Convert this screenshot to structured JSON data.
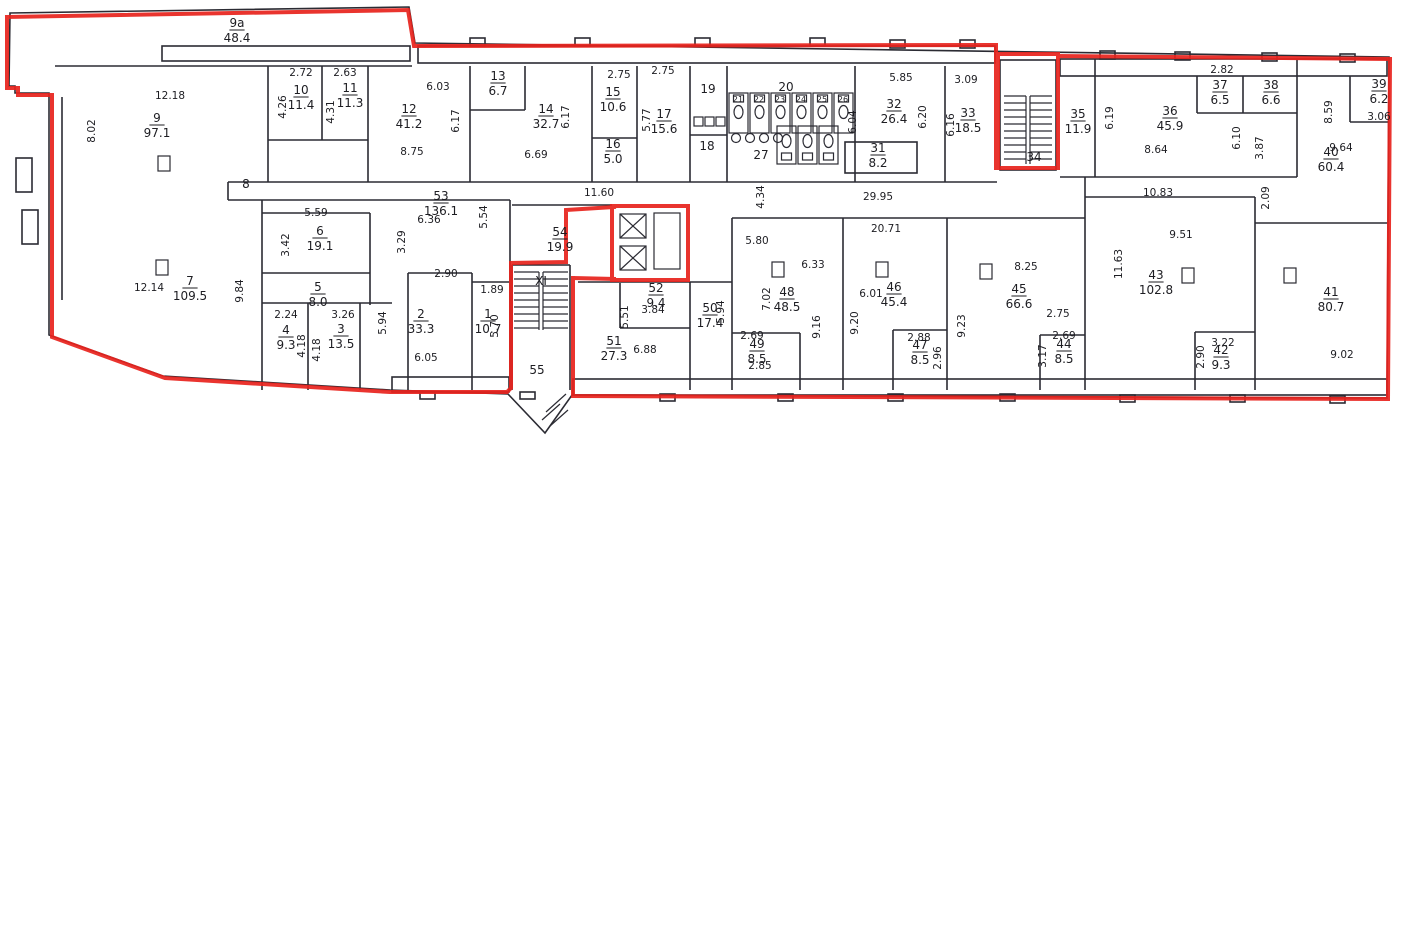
{
  "document": {
    "kind": "scanned floor plan with red lease-boundary outline",
    "background": "#ffffff"
  },
  "colors": {
    "boundary_red": "#e8231d",
    "wall_ink": "#2b2b33",
    "text_ink": "#1d1d22"
  },
  "rooms": [
    {
      "num": "9a",
      "area": "48.4",
      "x": 237,
      "y": 27
    },
    {
      "num": "9",
      "area": "97.1",
      "x": 157,
      "y": 122
    },
    {
      "num": "10",
      "area": "11.4",
      "x": 301,
      "y": 94
    },
    {
      "num": "11",
      "area": "11.3",
      "x": 350,
      "y": 92
    },
    {
      "num": "12",
      "area": "41.2",
      "x": 409,
      "y": 113
    },
    {
      "num": "13",
      "area": "6.7",
      "x": 498,
      "y": 80
    },
    {
      "num": "14",
      "area": "32.7",
      "x": 546,
      "y": 113
    },
    {
      "num": "15",
      "area": "10.6",
      "x": 613,
      "y": 96
    },
    {
      "num": "16",
      "area": "5.0",
      "x": 613,
      "y": 148
    },
    {
      "num": "17",
      "area": "15.6",
      "x": 664,
      "y": 118
    },
    {
      "num": "31",
      "area": "8.2",
      "x": 878,
      "y": 152
    },
    {
      "num": "32",
      "area": "26.4",
      "x": 894,
      "y": 108
    },
    {
      "num": "33",
      "area": "18.5",
      "x": 968,
      "y": 117
    },
    {
      "num": "35",
      "area": "11.9",
      "x": 1078,
      "y": 118
    },
    {
      "num": "36",
      "area": "45.9",
      "x": 1170,
      "y": 115
    },
    {
      "num": "37",
      "area": "6.5",
      "x": 1220,
      "y": 89
    },
    {
      "num": "38",
      "area": "6.6",
      "x": 1271,
      "y": 89
    },
    {
      "num": "39",
      "area": "6.2",
      "x": 1379,
      "y": 88
    },
    {
      "num": "40",
      "area": "60.4",
      "x": 1331,
      "y": 156
    },
    {
      "num": "7",
      "area": "109.5",
      "x": 190,
      "y": 285
    },
    {
      "num": "6",
      "area": "19.1",
      "x": 320,
      "y": 235
    },
    {
      "num": "5",
      "area": "8.0",
      "x": 318,
      "y": 291
    },
    {
      "num": "4",
      "area": "9.3",
      "x": 286,
      "y": 334
    },
    {
      "num": "3",
      "area": "13.5",
      "x": 341,
      "y": 333
    },
    {
      "num": "2",
      "area": "33.3",
      "x": 421,
      "y": 318
    },
    {
      "num": "1",
      "area": "10.7",
      "x": 488,
      "y": 318
    },
    {
      "num": "53",
      "area": "136.1",
      "x": 441,
      "y": 200
    },
    {
      "num": "54",
      "area": "19.9",
      "x": 560,
      "y": 236
    },
    {
      "num": "52",
      "area": "9.4",
      "x": 656,
      "y": 292
    },
    {
      "num": "51",
      "area": "27.3",
      "x": 614,
      "y": 345
    },
    {
      "num": "50",
      "area": "17.4",
      "x": 710,
      "y": 312
    },
    {
      "num": "48",
      "area": "48.5",
      "x": 787,
      "y": 296
    },
    {
      "num": "49",
      "area": "8.5",
      "x": 757,
      "y": 348
    },
    {
      "num": "46",
      "area": "45.4",
      "x": 894,
      "y": 291
    },
    {
      "num": "47",
      "area": "8.5",
      "x": 920,
      "y": 349
    },
    {
      "num": "45",
      "area": "66.6",
      "x": 1019,
      "y": 293
    },
    {
      "num": "44",
      "area": "8.5",
      "x": 1064,
      "y": 348
    },
    {
      "num": "43",
      "area": "102.8",
      "x": 1156,
      "y": 279
    },
    {
      "num": "42",
      "area": "9.3",
      "x": 1221,
      "y": 354
    },
    {
      "num": "41",
      "area": "80.7",
      "x": 1331,
      "y": 296
    }
  ],
  "labels": [
    {
      "text": "8",
      "x": 246,
      "y": 188,
      "small": false
    },
    {
      "text": "19",
      "x": 708,
      "y": 93,
      "small": false
    },
    {
      "text": "18",
      "x": 707,
      "y": 150,
      "small": false
    },
    {
      "text": "20",
      "x": 786,
      "y": 91,
      "small": false
    },
    {
      "text": "27",
      "x": 761,
      "y": 159,
      "small": false
    },
    {
      "text": "34",
      "x": 1034,
      "y": 161,
      "small": false
    },
    {
      "text": "55",
      "x": 537,
      "y": 374,
      "small": false
    },
    {
      "text": "XI",
      "x": 541,
      "y": 285,
      "small": false
    },
    {
      "text": "21",
      "x": 738,
      "y": 102,
      "small": true
    },
    {
      "text": "22",
      "x": 759,
      "y": 102,
      "small": true
    },
    {
      "text": "23",
      "x": 780,
      "y": 102,
      "small": true
    },
    {
      "text": "24",
      "x": 801,
      "y": 102,
      "small": true
    },
    {
      "text": "25",
      "x": 822,
      "y": 102,
      "small": true
    },
    {
      "text": "26",
      "x": 843,
      "y": 102,
      "small": true
    }
  ],
  "dimensions": [
    {
      "text": "12.18",
      "x": 170,
      "y": 99,
      "rot": 0
    },
    {
      "text": "8.02",
      "x": 95,
      "y": 131,
      "rot": 90
    },
    {
      "text": "2.72",
      "x": 301,
      "y": 76,
      "rot": 0
    },
    {
      "text": "4.26",
      "x": 286,
      "y": 107,
      "rot": 90
    },
    {
      "text": "2.63",
      "x": 345,
      "y": 76,
      "rot": 0
    },
    {
      "text": "4.31",
      "x": 334,
      "y": 112,
      "rot": 90
    },
    {
      "text": "6.03",
      "x": 438,
      "y": 90,
      "rot": 0
    },
    {
      "text": "6.17",
      "x": 459,
      "y": 121,
      "rot": 90
    },
    {
      "text": "8.75",
      "x": 412,
      "y": 155,
      "rot": 0
    },
    {
      "text": "6.17",
      "x": 569,
      "y": 117,
      "rot": 90
    },
    {
      "text": "6.69",
      "x": 536,
      "y": 158,
      "rot": 0
    },
    {
      "text": "2.75",
      "x": 619,
      "y": 78,
      "rot": 0
    },
    {
      "text": "2.75",
      "x": 663,
      "y": 74,
      "rot": 0
    },
    {
      "text": "5.77",
      "x": 650,
      "y": 120,
      "rot": 90
    },
    {
      "text": "5.85",
      "x": 901,
      "y": 81,
      "rot": 0
    },
    {
      "text": "6.04",
      "x": 856,
      "y": 122,
      "rot": 90
    },
    {
      "text": "6.20",
      "x": 926,
      "y": 117,
      "rot": 90
    },
    {
      "text": "6.16",
      "x": 954,
      "y": 125,
      "rot": 90
    },
    {
      "text": "3.09",
      "x": 966,
      "y": 83,
      "rot": 0
    },
    {
      "text": "6.19",
      "x": 1113,
      "y": 118,
      "rot": 90
    },
    {
      "text": "8.64",
      "x": 1156,
      "y": 153,
      "rot": 0
    },
    {
      "text": "2.82",
      "x": 1222,
      "y": 73,
      "rot": 0
    },
    {
      "text": "6.10",
      "x": 1240,
      "y": 138,
      "rot": 90
    },
    {
      "text": "3.87",
      "x": 1263,
      "y": 148,
      "rot": 90
    },
    {
      "text": "8.59",
      "x": 1332,
      "y": 112,
      "rot": 90
    },
    {
      "text": "3.06",
      "x": 1379,
      "y": 120,
      "rot": 0
    },
    {
      "text": "9.64",
      "x": 1341,
      "y": 151,
      "rot": 0
    },
    {
      "text": "11.60",
      "x": 599,
      "y": 196,
      "rot": 0
    },
    {
      "text": "4.34",
      "x": 764,
      "y": 197,
      "rot": 90
    },
    {
      "text": "29.95",
      "x": 878,
      "y": 200,
      "rot": 0
    },
    {
      "text": "20.71",
      "x": 886,
      "y": 232,
      "rot": 0
    },
    {
      "text": "10.83",
      "x": 1158,
      "y": 196,
      "rot": 0
    },
    {
      "text": "2.09",
      "x": 1269,
      "y": 198,
      "rot": 90
    },
    {
      "text": "9.51",
      "x": 1181,
      "y": 238,
      "rot": 0
    },
    {
      "text": "11.63",
      "x": 1122,
      "y": 264,
      "rot": 90
    },
    {
      "text": "5.59",
      "x": 316,
      "y": 216,
      "rot": 0
    },
    {
      "text": "3.42",
      "x": 289,
      "y": 245,
      "rot": 90
    },
    {
      "text": "6.36",
      "x": 429,
      "y": 223,
      "rot": 0
    },
    {
      "text": "3.29",
      "x": 405,
      "y": 242,
      "rot": 90
    },
    {
      "text": "5.54",
      "x": 487,
      "y": 217,
      "rot": 90
    },
    {
      "text": "2.90",
      "x": 446,
      "y": 277,
      "rot": 0
    },
    {
      "text": "1.89",
      "x": 492,
      "y": 293,
      "rot": 0
    },
    {
      "text": "5.70",
      "x": 498,
      "y": 326,
      "rot": 90
    },
    {
      "text": "5.94",
      "x": 386,
      "y": 323,
      "rot": 90
    },
    {
      "text": "2.24",
      "x": 286,
      "y": 318,
      "rot": 0
    },
    {
      "text": "3.26",
      "x": 343,
      "y": 318,
      "rot": 0
    },
    {
      "text": "4.18",
      "x": 305,
      "y": 346,
      "rot": 90
    },
    {
      "text": "4.18",
      "x": 320,
      "y": 350,
      "rot": 90
    },
    {
      "text": "12.14",
      "x": 149,
      "y": 291,
      "rot": 0
    },
    {
      "text": "9.84",
      "x": 243,
      "y": 291,
      "rot": 90
    },
    {
      "text": "6.05",
      "x": 426,
      "y": 361,
      "rot": 0
    },
    {
      "text": "5.80",
      "x": 757,
      "y": 244,
      "rot": 0
    },
    {
      "text": "6.33",
      "x": 813,
      "y": 268,
      "rot": 0
    },
    {
      "text": "7.02",
      "x": 770,
      "y": 299,
      "rot": 90
    },
    {
      "text": "9.16",
      "x": 820,
      "y": 327,
      "rot": 90
    },
    {
      "text": "2.69",
      "x": 752,
      "y": 339,
      "rot": 0
    },
    {
      "text": "2.85",
      "x": 760,
      "y": 369,
      "rot": 0
    },
    {
      "text": "6.01",
      "x": 871,
      "y": 297,
      "rot": 0
    },
    {
      "text": "9.20",
      "x": 858,
      "y": 323,
      "rot": 90
    },
    {
      "text": "2.88",
      "x": 919,
      "y": 341,
      "rot": 0
    },
    {
      "text": "2.96",
      "x": 941,
      "y": 358,
      "rot": 90
    },
    {
      "text": "9.23",
      "x": 965,
      "y": 326,
      "rot": 90
    },
    {
      "text": "8.25",
      "x": 1026,
      "y": 270,
      "rot": 0
    },
    {
      "text": "2.75",
      "x": 1058,
      "y": 317,
      "rot": 0
    },
    {
      "text": "2.69",
      "x": 1064,
      "y": 339,
      "rot": 0
    },
    {
      "text": "3.17",
      "x": 1046,
      "y": 356,
      "rot": 90
    },
    {
      "text": "5.94",
      "x": 724,
      "y": 312,
      "rot": 90
    },
    {
      "text": "5.51",
      "x": 628,
      "y": 317,
      "rot": 90
    },
    {
      "text": "6.88",
      "x": 645,
      "y": 353,
      "rot": 0
    },
    {
      "text": "3.84",
      "x": 653,
      "y": 313,
      "rot": 0
    },
    {
      "text": "3.22",
      "x": 1223,
      "y": 346,
      "rot": 0
    },
    {
      "text": "2.90",
      "x": 1204,
      "y": 357,
      "rot": 90
    },
    {
      "text": "9.02",
      "x": 1342,
      "y": 358,
      "rot": 0
    }
  ]
}
